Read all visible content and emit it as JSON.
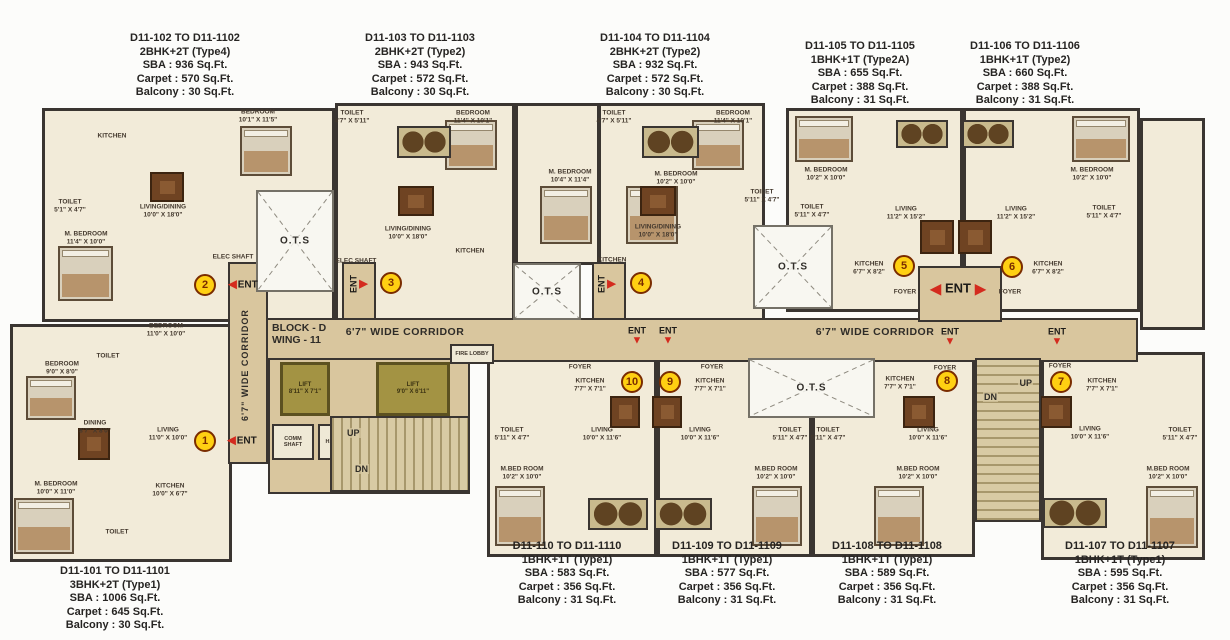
{
  "block": {
    "line1": "BLOCK - D",
    "line2": "WING - 11"
  },
  "corridor": {
    "horizontal": "6'7\" WIDE CORRIDOR",
    "vertical": "6'7\" WIDE CORRIDOR"
  },
  "areas": {
    "ots": "O.T.S",
    "lift1_line1": "LIFT",
    "lift1_line2": "8'11\" X 7'1\"",
    "lift2_line1": "LIFT",
    "lift2_line2": "9'0\" X 6'11\"",
    "up": "UP",
    "dn": "DN",
    "comm_shaft": "COMM SHAFT",
    "hc": "H.C.",
    "fire_lobby": "FIRE LOBBY",
    "ent": "ENT"
  },
  "units": {
    "u101": {
      "range": "D11-101 TO D11-1101",
      "type": "3BHK+2T (Type1)",
      "sba": "SBA : 1006 Sq.Ft.",
      "carpet": "Carpet : 645 Sq.Ft.",
      "balcony": "Balcony : 30 Sq.Ft."
    },
    "u102": {
      "range": "D11-102 TO D11-1102",
      "type": "2BHK+2T (Type4)",
      "sba": "SBA : 936 Sq.Ft.",
      "carpet": "Carpet : 570 Sq.Ft.",
      "balcony": "Balcony : 30 Sq.Ft."
    },
    "u103": {
      "range": "D11-103 TO D11-1103",
      "type": "2BHK+2T (Type2)",
      "sba": "SBA : 943 Sq.Ft.",
      "carpet": "Carpet : 572 Sq.Ft.",
      "balcony": "Balcony : 30 Sq.Ft."
    },
    "u104": {
      "range": "D11-104 TO D11-1104",
      "type": "2BHK+2T (Type2)",
      "sba": "SBA : 932 Sq.Ft.",
      "carpet": "Carpet : 572 Sq.Ft.",
      "balcony": "Balcony : 30 Sq.Ft."
    },
    "u105": {
      "range": "D11-105 TO D11-1105",
      "type": "1BHK+1T (Type2A)",
      "sba": "SBA : 655 Sq.Ft.",
      "carpet": "Carpet : 388 Sq.Ft.",
      "balcony": "Balcony : 31 Sq.Ft."
    },
    "u106": {
      "range": "D11-106 TO D11-1106",
      "type": "1BHK+1T (Type2)",
      "sba": "SBA : 660 Sq.Ft.",
      "carpet": "Carpet : 388 Sq.Ft.",
      "balcony": "Balcony : 31 Sq.Ft."
    },
    "u107": {
      "range": "D11-107 TO D11-1107",
      "type": "1BHK+1T (Type1)",
      "sba": "SBA : 595 Sq.Ft.",
      "carpet": "Carpet : 356 Sq.Ft.",
      "balcony": "Balcony : 31 Sq.Ft."
    },
    "u108": {
      "range": "D11-108 TO D11-1108",
      "type": "1BHK+1T (Type1)",
      "sba": "SBA : 589 Sq.Ft.",
      "carpet": "Carpet : 356 Sq.Ft.",
      "balcony": "Balcony : 31 Sq.Ft."
    },
    "u109": {
      "range": "D11-109 TO D11-1109",
      "type": "1BHK+1T (Type1)",
      "sba": "SBA : 577 Sq.Ft.",
      "carpet": "Carpet : 356 Sq.Ft.",
      "balcony": "Balcony : 31 Sq.Ft."
    },
    "u110": {
      "range": "D11-110 TO D11-1110",
      "type": "1BHK+1T (Type1)",
      "sba": "SBA : 583 Sq.Ft.",
      "carpet": "Carpet : 356 Sq.Ft.",
      "balcony": "Balcony : 31 Sq.Ft."
    }
  },
  "plan": {
    "rooms": [
      {
        "n": "BEDROOM",
        "d": "10'1\" X 11'5\"",
        "x": 258,
        "y": 116
      },
      {
        "n": "KITCHEN",
        "d": "",
        "x": 112,
        "y": 136
      },
      {
        "n": "TOILET",
        "d": "5'1\" X 4'7\"",
        "x": 70,
        "y": 206
      },
      {
        "n": "LIVING/DINING",
        "d": "10'0\" X 18'0\"",
        "x": 163,
        "y": 211
      },
      {
        "n": "M. BEDROOM",
        "d": "11'4\" X 10'0\"",
        "x": 86,
        "y": 238
      },
      {
        "n": "TOILET",
        "d": "4'7\" X 5'11\"",
        "x": 352,
        "y": 117
      },
      {
        "n": "BEDROOM",
        "d": "11'4\" X 10'1\"",
        "x": 473,
        "y": 117
      },
      {
        "n": "M. BEDROOM",
        "d": "10'4\" X 11'4\"",
        "x": 570,
        "y": 176
      },
      {
        "n": "LIVING/DINING",
        "d": "10'0\" X 18'0\"",
        "x": 408,
        "y": 233
      },
      {
        "n": "KITCHEN",
        "d": "",
        "x": 470,
        "y": 251
      },
      {
        "n": "TOILET",
        "d": "4'7\" X 5'11\"",
        "x": 614,
        "y": 117
      },
      {
        "n": "BEDROOM",
        "d": "11'4\" X 10'1\"",
        "x": 733,
        "y": 117
      },
      {
        "n": "M. BEDROOM",
        "d": "10'2\" X 10'0\"",
        "x": 676,
        "y": 178
      },
      {
        "n": "TOILET",
        "d": "5'11\" X 4'7\"",
        "x": 762,
        "y": 196
      },
      {
        "n": "LIVING/DINING",
        "d": "10'0\" X 18'0\"",
        "x": 658,
        "y": 231
      },
      {
        "n": "KITCHEN",
        "d": "",
        "x": 612,
        "y": 260
      },
      {
        "n": "M. BEDROOM",
        "d": "10'2\" X 10'0\"",
        "x": 826,
        "y": 174
      },
      {
        "n": "TOILET",
        "d": "5'11\" X 4'7\"",
        "x": 812,
        "y": 211
      },
      {
        "n": "LIVING",
        "d": "11'2\" X 15'2\"",
        "x": 906,
        "y": 213
      },
      {
        "n": "KITCHEN",
        "d": "6'7\" X 8'2\"",
        "x": 869,
        "y": 268
      },
      {
        "n": "FOYER",
        "d": "",
        "x": 905,
        "y": 292
      },
      {
        "n": "M. BEDROOM",
        "d": "10'2\" X 10'0\"",
        "x": 1092,
        "y": 174
      },
      {
        "n": "TOILET",
        "d": "5'11\" X 4'7\"",
        "x": 1104,
        "y": 212
      },
      {
        "n": "LIVING",
        "d": "11'2\" X 15'2\"",
        "x": 1016,
        "y": 213
      },
      {
        "n": "KITCHEN",
        "d": "6'7\" X 8'2\"",
        "x": 1048,
        "y": 268
      },
      {
        "n": "FOYER",
        "d": "",
        "x": 1010,
        "y": 292
      },
      {
        "n": "BEDROOM",
        "d": "9'0\" X 8'0\"",
        "x": 62,
        "y": 368
      },
      {
        "n": "TOILET",
        "d": "",
        "x": 108,
        "y": 356
      },
      {
        "n": "BEDROOM",
        "d": "11'0\" X 10'0\"",
        "x": 166,
        "y": 330
      },
      {
        "n": "DINING",
        "d": "8'7\" X 8'0\"",
        "x": 95,
        "y": 427
      },
      {
        "n": "LIVING",
        "d": "11'0\" X 10'0\"",
        "x": 168,
        "y": 434
      },
      {
        "n": "M. BEDROOM",
        "d": "10'0\" X 11'0\"",
        "x": 56,
        "y": 488
      },
      {
        "n": "KITCHEN",
        "d": "10'0\" X 6'7\"",
        "x": 170,
        "y": 490
      },
      {
        "n": "TOILET",
        "d": "",
        "x": 117,
        "y": 532
      },
      {
        "n": "FOYER",
        "d": "",
        "x": 580,
        "y": 367
      },
      {
        "n": "KITCHEN",
        "d": "7'7\" X 7'1\"",
        "x": 590,
        "y": 385
      },
      {
        "n": "TOILET",
        "d": "5'11\" X 4'7\"",
        "x": 512,
        "y": 434
      },
      {
        "n": "LIVING",
        "d": "10'0\" X 11'6\"",
        "x": 602,
        "y": 434
      },
      {
        "n": "M.BED ROOM",
        "d": "10'2\" X 10'0\"",
        "x": 522,
        "y": 473
      },
      {
        "n": "FOYER",
        "d": "",
        "x": 712,
        "y": 367
      },
      {
        "n": "KITCHEN",
        "d": "7'7\" X 7'1\"",
        "x": 710,
        "y": 385
      },
      {
        "n": "LIVING",
        "d": "10'0\" X 11'6\"",
        "x": 700,
        "y": 434
      },
      {
        "n": "TOILET",
        "d": "5'11\" X 4'7\"",
        "x": 790,
        "y": 434
      },
      {
        "n": "M.BED ROOM",
        "d": "10'2\" X 10'0\"",
        "x": 776,
        "y": 473
      },
      {
        "n": "FOYER",
        "d": "",
        "x": 945,
        "y": 368
      },
      {
        "n": "KITCHEN",
        "d": "7'7\" X 7'1\"",
        "x": 900,
        "y": 383
      },
      {
        "n": "TOILET",
        "d": "5'11\" X 4'7\"",
        "x": 828,
        "y": 434
      },
      {
        "n": "LIVING",
        "d": "10'0\" X 11'6\"",
        "x": 928,
        "y": 434
      },
      {
        "n": "M.BED ROOM",
        "d": "10'2\" X 10'0\"",
        "x": 918,
        "y": 473
      },
      {
        "n": "FOYER",
        "d": "",
        "x": 1060,
        "y": 366
      },
      {
        "n": "KITCHEN",
        "d": "7'7\" X 7'1\"",
        "x": 1102,
        "y": 385
      },
      {
        "n": "LIVING",
        "d": "10'0\" X 11'6\"",
        "x": 1090,
        "y": 433
      },
      {
        "n": "TOILET",
        "d": "5'11\" X 4'7\"",
        "x": 1180,
        "y": 434
      },
      {
        "n": "M.BED ROOM",
        "d": "10'2\" X 10'0\"",
        "x": 1168,
        "y": 473
      },
      {
        "n": "ELEC SHAFT",
        "d": "",
        "x": 233,
        "y": 257
      },
      {
        "n": "ELEC SHAFT",
        "d": "",
        "x": 356,
        "y": 261
      }
    ],
    "circles": [
      {
        "n": "1",
        "x": 205,
        "y": 441
      },
      {
        "n": "2",
        "x": 205,
        "y": 285
      },
      {
        "n": "3",
        "x": 391,
        "y": 283
      },
      {
        "n": "4",
        "x": 641,
        "y": 283
      },
      {
        "n": "5",
        "x": 904,
        "y": 266
      },
      {
        "n": "6",
        "x": 1012,
        "y": 267
      },
      {
        "n": "7",
        "x": 1061,
        "y": 382
      },
      {
        "n": "8",
        "x": 947,
        "y": 381
      },
      {
        "n": "9",
        "x": 670,
        "y": 382
      },
      {
        "n": "10",
        "x": 632,
        "y": 382
      }
    ],
    "ents": [
      {
        "style": "h",
        "x": 242,
        "y": 441
      },
      {
        "style": "h",
        "x": 243,
        "y": 285
      },
      {
        "style": "v",
        "x": 358,
        "y": 284
      },
      {
        "style": "v",
        "x": 606,
        "y": 284
      },
      {
        "style": "lr",
        "x": 958,
        "y": 288
      },
      {
        "style": "down",
        "x": 637,
        "y": 336
      },
      {
        "style": "down",
        "x": 668,
        "y": 336
      },
      {
        "style": "down",
        "x": 950,
        "y": 337
      },
      {
        "style": "down",
        "x": 1057,
        "y": 337
      }
    ],
    "beds": [
      [
        240,
        126,
        52,
        50
      ],
      [
        58,
        246,
        55,
        55
      ],
      [
        445,
        120,
        52,
        50
      ],
      [
        540,
        186,
        52,
        58
      ],
      [
        692,
        120,
        52,
        50
      ],
      [
        626,
        186,
        52,
        58
      ],
      [
        795,
        116,
        58,
        46
      ],
      [
        1072,
        116,
        58,
        46
      ],
      [
        26,
        376,
        50,
        44
      ],
      [
        14,
        498,
        60,
        56
      ],
      [
        495,
        486,
        50,
        60
      ],
      [
        752,
        486,
        50,
        60
      ],
      [
        874,
        486,
        50,
        60
      ],
      [
        1146,
        486,
        52,
        62
      ]
    ],
    "tables": [
      [
        150,
        172,
        34,
        30
      ],
      [
        398,
        186,
        36,
        30
      ],
      [
        640,
        186,
        36,
        30
      ],
      [
        920,
        220,
        34,
        34
      ],
      [
        958,
        220,
        34,
        34
      ],
      [
        78,
        428,
        32,
        32
      ],
      [
        610,
        396,
        30,
        32
      ],
      [
        652,
        396,
        30,
        32
      ],
      [
        903,
        396,
        32,
        32
      ],
      [
        1040,
        396,
        32,
        32
      ]
    ],
    "balconies": [
      [
        397,
        126,
        54,
        32
      ],
      [
        642,
        126,
        57,
        32
      ],
      [
        896,
        120,
        52,
        28
      ],
      [
        962,
        120,
        52,
        28
      ],
      [
        588,
        498,
        60,
        32
      ],
      [
        654,
        498,
        58,
        32
      ],
      [
        1043,
        498,
        64,
        30
      ]
    ]
  }
}
